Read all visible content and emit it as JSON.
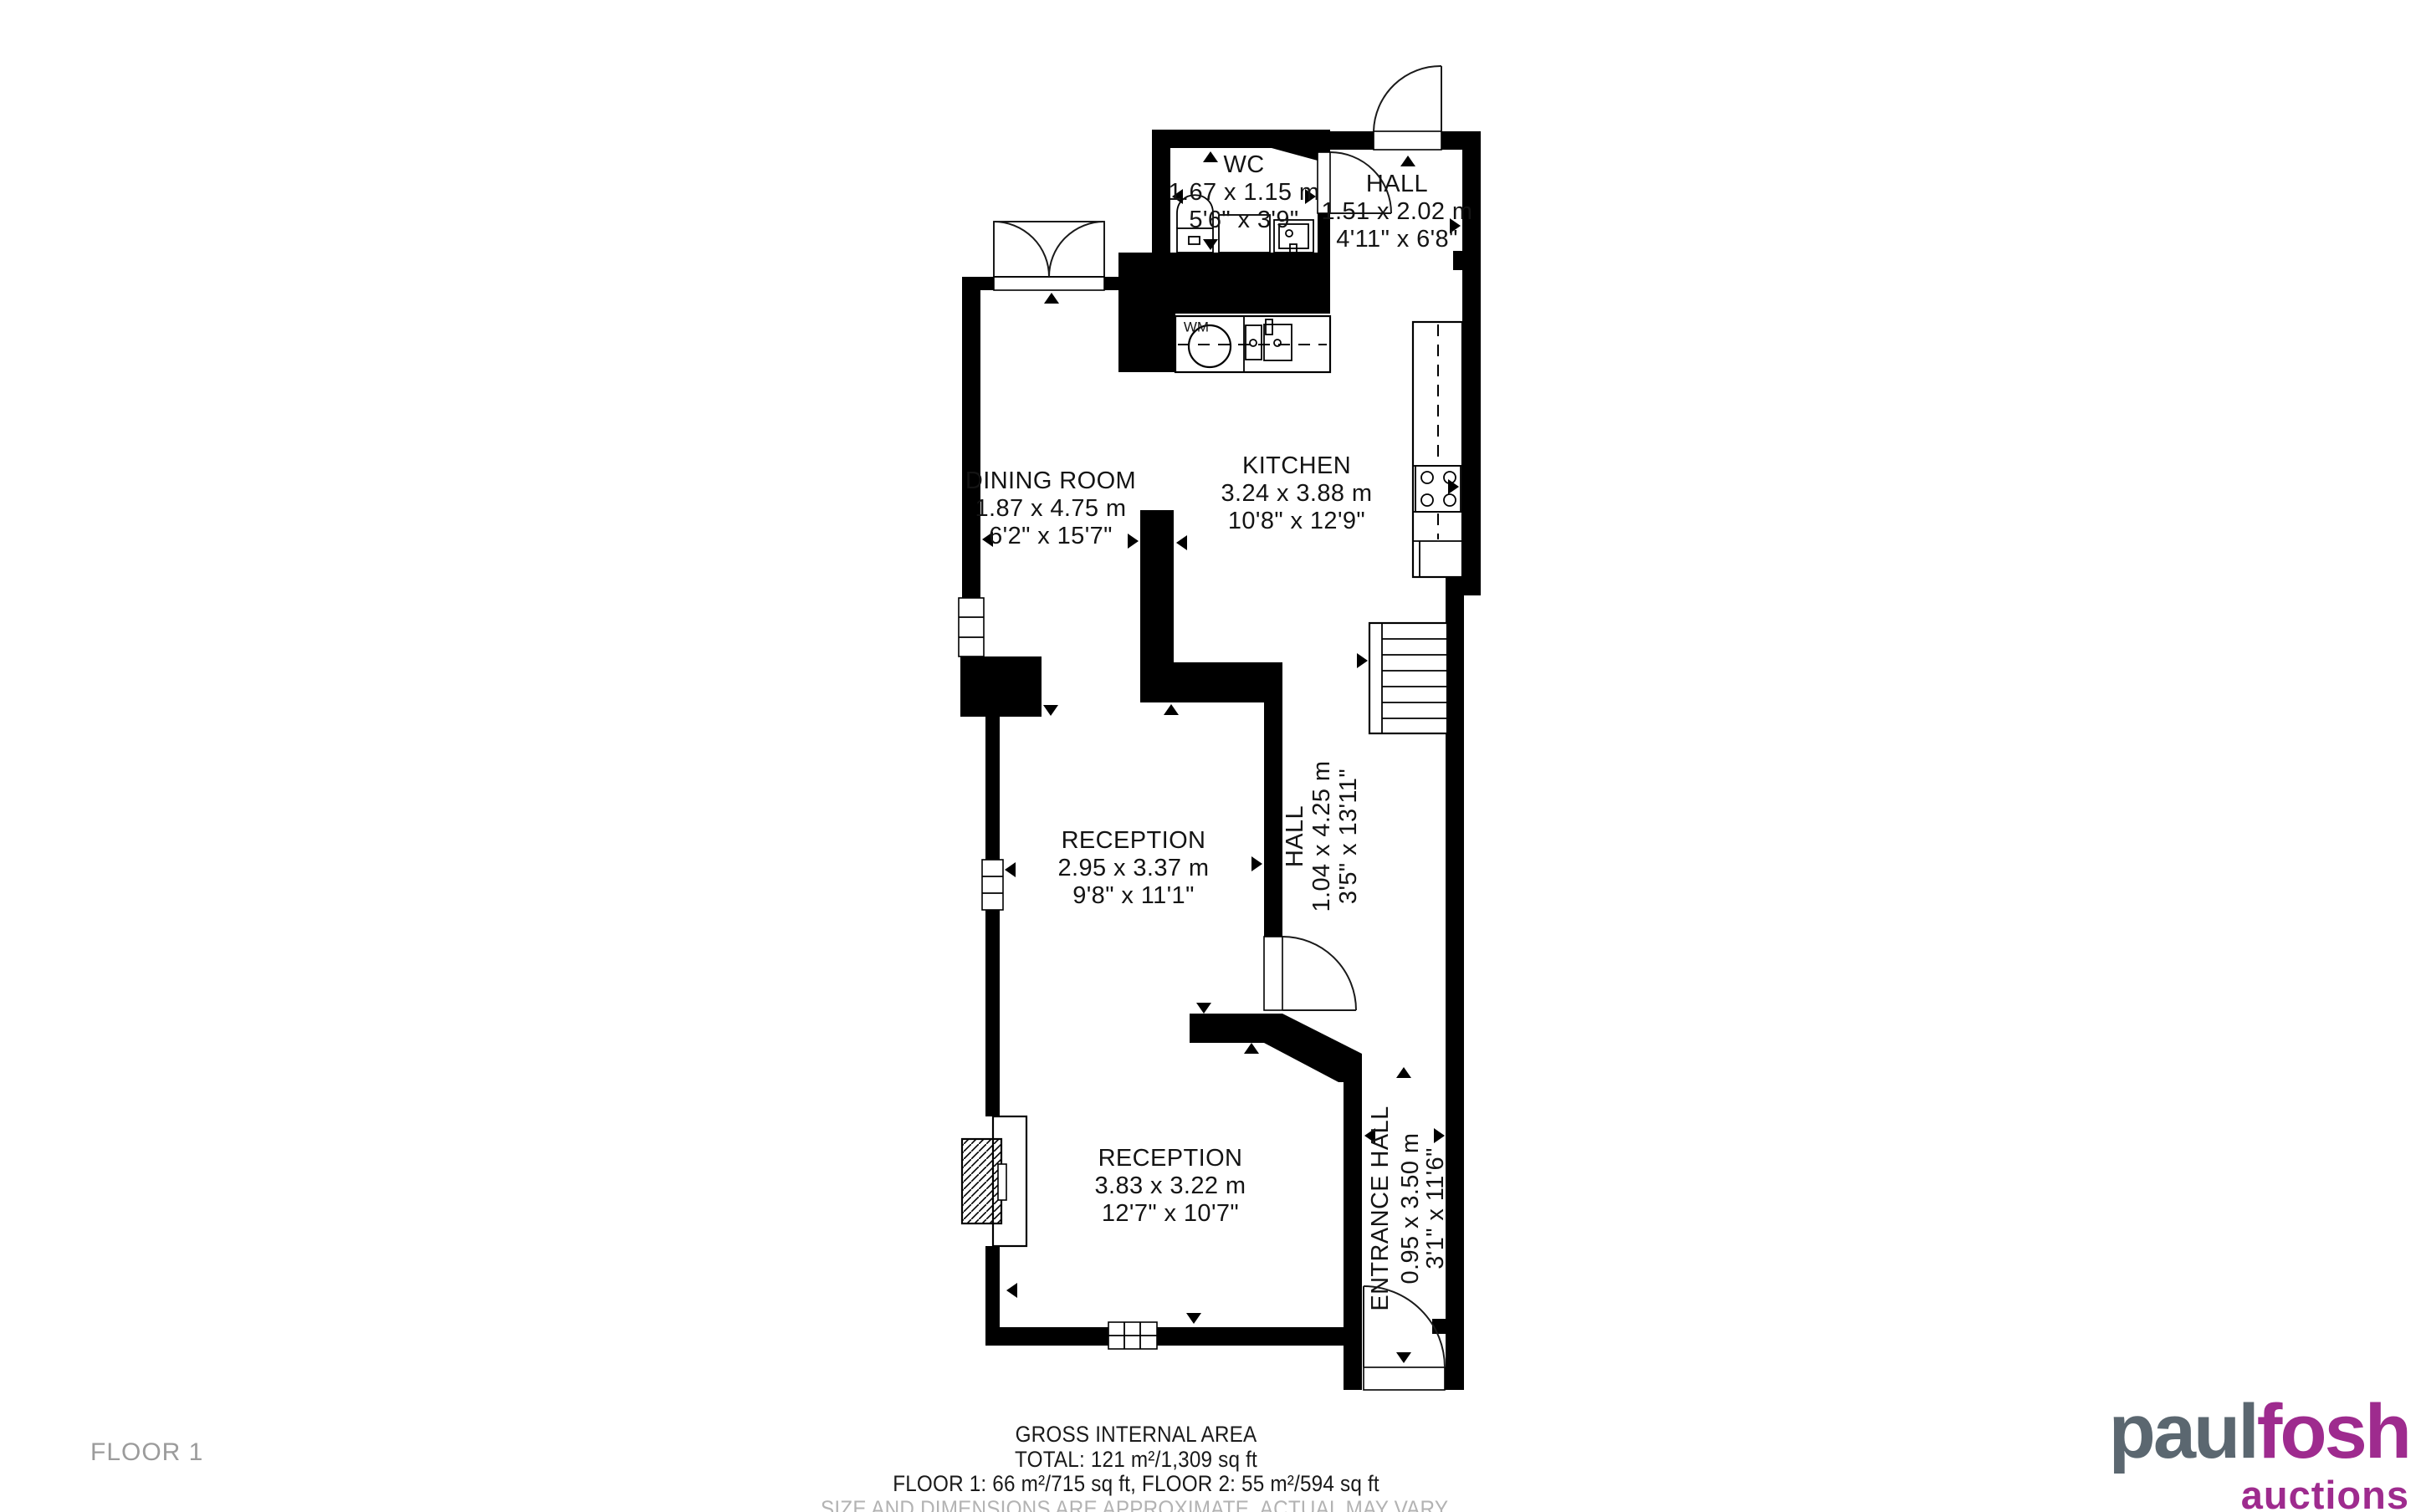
{
  "rooms": [
    {
      "name": "WC",
      "metric": "1.67 x 1.15 m",
      "imperial": "5'6\" x 3'9\""
    },
    {
      "name": "HALL",
      "metric": "1.51 x 2.02 m",
      "imperial": "4'11\" x 6'8\""
    },
    {
      "name": "DINING ROOM",
      "metric": "1.87 x 4.75 m",
      "imperial": "6'2\" x 15'7\""
    },
    {
      "name": "KITCHEN",
      "metric": "3.24 x 3.88 m",
      "imperial": "10'8\" x 12'9\""
    },
    {
      "name": "RECEPTION",
      "metric": "2.95 x 3.37 m",
      "imperial": "9'8\" x 11'1\""
    },
    {
      "name": "HALL",
      "metric": "1.04 x 4.25 m",
      "imperial": "3'5\" x 13'11\""
    },
    {
      "name": "RECEPTION",
      "metric": "3.83 x 3.22 m",
      "imperial": "12'7\" x 10'7\""
    },
    {
      "name": "ENTRANCE HALL",
      "metric": "0.95 x 3.50 m",
      "imperial": "3'1\" x 11'6\""
    }
  ],
  "fixtures": {
    "washing_machine_label": "WM"
  },
  "floor_label": "FLOOR 1",
  "footer": {
    "title": "GROSS INTERNAL AREA",
    "total": "TOTAL: 121 m²/1,309 sq ft",
    "floors": "FLOOR 1: 66 m²/715 sq ft, FLOOR 2: 55 m²/594 sq ft",
    "disclaimer": "SIZE AND DIMENSIONS ARE APPROXIMATE, ACTUAL MAY VARY."
  },
  "logo": {
    "part1": "paul",
    "part2": "fosh",
    "part3": "auctions",
    "color_gray": "#5b6770",
    "color_purple": "#9e2b8e"
  },
  "colors": {
    "wall": "#000000",
    "label_text": "#141414",
    "muted_text": "#9b9b9b",
    "disclaimer_text": "#b3b3b3"
  }
}
